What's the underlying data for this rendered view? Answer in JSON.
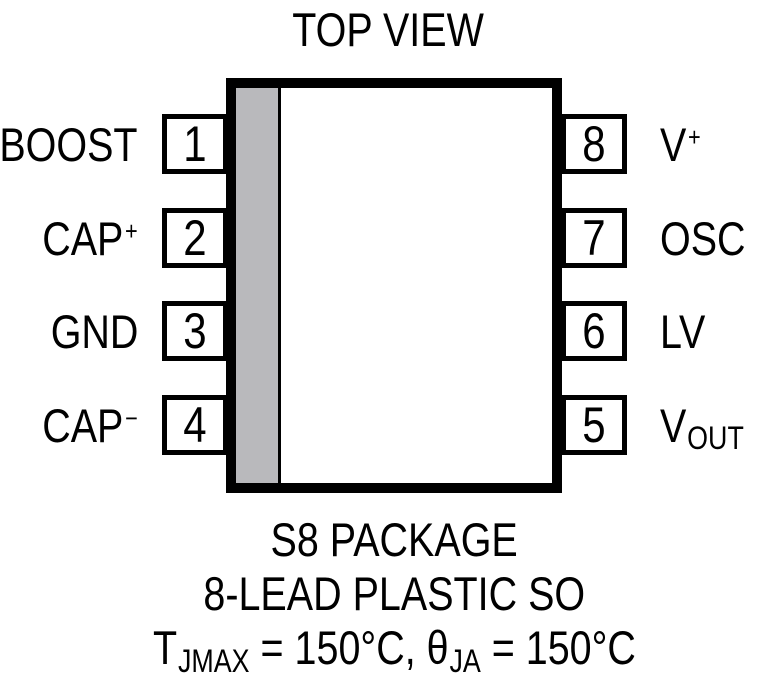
{
  "title": "TOP VIEW",
  "package": {
    "stripe_color": "#b9b9bc",
    "body_color": "#ffffff",
    "ink_color": "#000000"
  },
  "pins": {
    "left": [
      {
        "number": "1",
        "label": {
          "base": "BOOST"
        }
      },
      {
        "number": "2",
        "label": {
          "base": "CAP",
          "sup": "+"
        }
      },
      {
        "number": "3",
        "label": {
          "base": "GND"
        }
      },
      {
        "number": "4",
        "label": {
          "base": "CAP",
          "sup": "−"
        }
      }
    ],
    "right": [
      {
        "number": "8",
        "label": {
          "base": "V",
          "sup": "+"
        }
      },
      {
        "number": "7",
        "label": {
          "base": "OSC"
        }
      },
      {
        "number": "6",
        "label": {
          "base": "LV"
        }
      },
      {
        "number": "5",
        "label": {
          "base": "V",
          "sub": "OUT"
        }
      }
    ]
  },
  "captions": {
    "line1": "S8 PACKAGE",
    "line2": "8-LEAD PLASTIC SO",
    "line3_parts": [
      {
        "t": "T"
      },
      {
        "sub": "JMAX"
      },
      {
        "t": " = 150°C, "
      },
      {
        "t": "θ"
      },
      {
        "sub": "JA"
      },
      {
        "t": " = 150°C"
      }
    ]
  }
}
